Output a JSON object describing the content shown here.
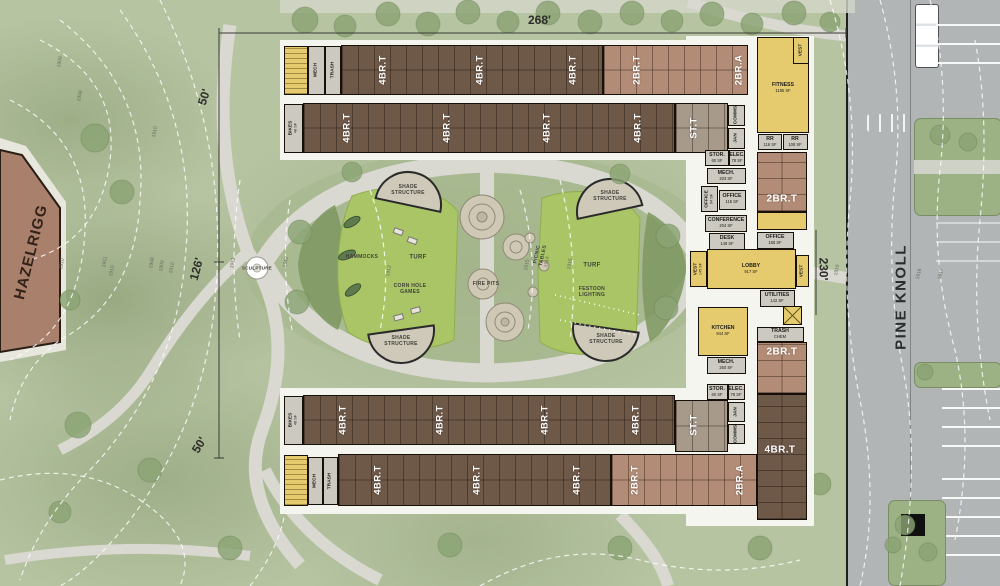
{
  "site": {
    "adjacent_building": "HAZELRIGG",
    "street": "PINE KNOLL"
  },
  "dimensions": {
    "top": "268'",
    "left_upper": "50'",
    "left_mid": "126'",
    "left_lower": "50'",
    "right": "230'"
  },
  "palette": {
    "dark_unit": "#6e5848",
    "light_unit": "#b28c76",
    "amenity_yellow": "#e5cb6e",
    "service_gray": "#ccc9c1",
    "studio_gray": "#a79a8b",
    "turf_green": "#a9c566",
    "grass": "#b7c4a2",
    "path": "#d9d8d1",
    "road": "#b1b5b6"
  },
  "render": {
    "blocks": [
      {
        "n": "pad-north",
        "cls": "pad",
        "x": 280,
        "y": 40,
        "w": 470,
        "h": 120
      },
      {
        "n": "pad-south",
        "cls": "pad",
        "x": 280,
        "y": 388,
        "w": 482,
        "h": 126
      },
      {
        "n": "pad-east",
        "cls": "pad",
        "x": 686,
        "y": 36,
        "w": 128,
        "h": 490
      },
      {
        "n": "stair-room",
        "cls": "f-yel st",
        "x": 284,
        "y": 46,
        "w": 24,
        "h": 49
      },
      {
        "n": "mech-room",
        "cls": "f-gray",
        "x": 308,
        "y": 46,
        "w": 17,
        "h": 49
      },
      {
        "n": "trash-room",
        "cls": "f-gray",
        "x": 325,
        "y": 46,
        "w": 16,
        "h": 49
      },
      {
        "n": "residential-wing",
        "cls": "f-dark u-v",
        "x": 341,
        "y": 45,
        "w": 262,
        "h": 50
      },
      {
        "n": "residential-wing",
        "cls": "f-light u-v",
        "x": 603,
        "y": 45,
        "w": 145,
        "h": 50
      },
      {
        "n": "bike-room",
        "cls": "f-gray",
        "x": 284,
        "y": 104,
        "w": 19,
        "h": 49
      },
      {
        "n": "residential-wing",
        "cls": "f-dark u-v",
        "x": 303,
        "y": 103,
        "w": 372,
        "h": 50
      },
      {
        "n": "studio-wing",
        "cls": "f-stud u-v",
        "x": 675,
        "y": 103,
        "w": 53,
        "h": 50
      },
      {
        "n": "comms-room",
        "cls": "f-gray",
        "x": 728,
        "y": 105,
        "w": 17,
        "h": 21
      },
      {
        "n": "jan-room",
        "cls": "f-gray",
        "x": 728,
        "y": 128,
        "w": 17,
        "h": 21
      },
      {
        "n": "fitness-room",
        "cls": "f-yel",
        "x": 757,
        "y": 37,
        "w": 52,
        "h": 96
      },
      {
        "n": "vest-room",
        "cls": "f-yel",
        "x": 793,
        "y": 37,
        "w": 16,
        "h": 27
      },
      {
        "n": "restroom",
        "cls": "f-gray",
        "x": 758,
        "y": 134,
        "w": 24,
        "h": 16
      },
      {
        "n": "restroom",
        "cls": "f-gray",
        "x": 783,
        "y": 134,
        "w": 25,
        "h": 16
      },
      {
        "n": "stor-room",
        "cls": "f-gray",
        "x": 705,
        "y": 150,
        "w": 24,
        "h": 16
      },
      {
        "n": "elec-room",
        "cls": "f-gray",
        "x": 729,
        "y": 150,
        "w": 16,
        "h": 16
      },
      {
        "n": "mech-room",
        "cls": "f-gray",
        "x": 707,
        "y": 168,
        "w": 39,
        "h": 16
      },
      {
        "n": "office-room",
        "cls": "f-gray",
        "x": 701,
        "y": 186,
        "w": 17,
        "h": 26
      },
      {
        "n": "office-room",
        "cls": "f-gray",
        "x": 719,
        "y": 190,
        "w": 27,
        "h": 20
      },
      {
        "n": "apartment-2brt",
        "cls": "f-light u-h",
        "x": 757,
        "y": 152,
        "w": 50,
        "h": 60
      },
      {
        "n": "balcony-room",
        "cls": "f-yel",
        "x": 757,
        "y": 212,
        "w": 50,
        "h": 18
      },
      {
        "n": "conference-room",
        "cls": "f-gray",
        "x": 705,
        "y": 215,
        "w": 42,
        "h": 17
      },
      {
        "n": "desk-room",
        "cls": "f-gray",
        "x": 709,
        "y": 233,
        "w": 36,
        "h": 17
      },
      {
        "n": "office-room",
        "cls": "f-gray",
        "x": 757,
        "y": 232,
        "w": 37,
        "h": 17
      },
      {
        "n": "vest-room",
        "cls": "f-yel",
        "x": 690,
        "y": 251,
        "w": 17,
        "h": 36
      },
      {
        "n": "lobby-room",
        "cls": "f-yel",
        "x": 707,
        "y": 249,
        "w": 89,
        "h": 40
      },
      {
        "n": "vest-room",
        "cls": "f-yel",
        "x": 796,
        "y": 255,
        "w": 13,
        "h": 32
      },
      {
        "n": "utilities-room",
        "cls": "f-gray",
        "x": 760,
        "y": 290,
        "w": 35,
        "h": 17
      },
      {
        "n": "kitchen-room",
        "cls": "f-yel",
        "x": 698,
        "y": 307,
        "w": 50,
        "h": 49
      },
      {
        "n": "stair-x-room",
        "cls": "f-yel xr",
        "x": 783,
        "y": 306,
        "w": 19,
        "h": 19
      },
      {
        "n": "trash-room",
        "cls": "f-gray",
        "x": 757,
        "y": 327,
        "w": 47,
        "h": 15
      },
      {
        "n": "apartment-2brt",
        "cls": "f-light u-h",
        "x": 757,
        "y": 342,
        "w": 50,
        "h": 52
      },
      {
        "n": "mech-room",
        "cls": "f-gray",
        "x": 707,
        "y": 357,
        "w": 39,
        "h": 17
      },
      {
        "n": "stor-room",
        "cls": "f-gray",
        "x": 707,
        "y": 384,
        "w": 21,
        "h": 16
      },
      {
        "n": "elec-room",
        "cls": "f-gray",
        "x": 728,
        "y": 384,
        "w": 17,
        "h": 16
      },
      {
        "n": "bike-room",
        "cls": "f-gray",
        "x": 284,
        "y": 396,
        "w": 19,
        "h": 49
      },
      {
        "n": "residential-wing",
        "cls": "f-dark u-v",
        "x": 303,
        "y": 395,
        "w": 372,
        "h": 50
      },
      {
        "n": "studio-wing",
        "cls": "f-stud u-v",
        "x": 675,
        "y": 400,
        "w": 53,
        "h": 52
      },
      {
        "n": "jan-room",
        "cls": "f-gray",
        "x": 728,
        "y": 402,
        "w": 17,
        "h": 20
      },
      {
        "n": "comms-room",
        "cls": "f-gray",
        "x": 728,
        "y": 424,
        "w": 17,
        "h": 20
      },
      {
        "n": "stair-room",
        "cls": "f-yel st",
        "x": 284,
        "y": 455,
        "w": 24,
        "h": 51
      },
      {
        "n": "mech-room",
        "cls": "f-gray",
        "x": 308,
        "y": 457,
        "w": 15,
        "h": 48
      },
      {
        "n": "trash-room",
        "cls": "f-gray",
        "x": 323,
        "y": 457,
        "w": 15,
        "h": 48
      },
      {
        "n": "residential-wing",
        "cls": "f-dark u-v",
        "x": 338,
        "y": 454,
        "w": 273,
        "h": 52
      },
      {
        "n": "residential-wing",
        "cls": "f-light u-v",
        "x": 611,
        "y": 454,
        "w": 146,
        "h": 52
      },
      {
        "n": "residential-wing",
        "cls": "f-dark u-h",
        "x": 757,
        "y": 394,
        "w": 50,
        "h": 126
      }
    ],
    "unit_labels": [
      {
        "t": "4BR.T",
        "x": 383,
        "y": 70
      },
      {
        "t": "4BR.T",
        "x": 480,
        "y": 70
      },
      {
        "t": "4BR.T",
        "x": 573,
        "y": 70
      },
      {
        "t": "2BR.T",
        "x": 637,
        "y": 70
      },
      {
        "t": "2BR.A",
        "x": 739,
        "y": 70
      },
      {
        "t": "4BR.T",
        "x": 347,
        "y": 128
      },
      {
        "t": "4BR.T",
        "x": 447,
        "y": 128
      },
      {
        "t": "4BR.T",
        "x": 547,
        "y": 128
      },
      {
        "t": "4BR.T",
        "x": 638,
        "y": 128
      },
      {
        "t": "ST.T",
        "x": 694,
        "y": 128
      },
      {
        "t": "4BR.T",
        "x": 343,
        "y": 420
      },
      {
        "t": "4BR.T",
        "x": 440,
        "y": 420
      },
      {
        "t": "4BR.T",
        "x": 545,
        "y": 420
      },
      {
        "t": "4BR.T",
        "x": 636,
        "y": 420
      },
      {
        "t": "ST.T",
        "x": 694,
        "y": 425
      },
      {
        "t": "4BR.T",
        "x": 378,
        "y": 480
      },
      {
        "t": "4BR.T",
        "x": 477,
        "y": 480
      },
      {
        "t": "4BR.T",
        "x": 577,
        "y": 480
      },
      {
        "t": "2BR.T",
        "x": 635,
        "y": 480
      },
      {
        "t": "2BR.A",
        "x": 740,
        "y": 480
      },
      {
        "t": "2BR.T",
        "x": 782,
        "y": 199,
        "h": true,
        "s": 10
      },
      {
        "t": "2BR.T",
        "x": 782,
        "y": 352,
        "h": true,
        "s": 10
      },
      {
        "t": "4BR.T",
        "x": 780,
        "y": 450,
        "h": true,
        "s": 10
      }
    ],
    "service_labels": [
      {
        "t": "MECH",
        "x": 316,
        "y": 70
      },
      {
        "t": "TRASH",
        "x": 333,
        "y": 70
      },
      {
        "t": "BIKES",
        "sf": "48 SF",
        "x": 293,
        "y": 128
      },
      {
        "t": "COMMS",
        "x": 736,
        "y": 115
      },
      {
        "t": "JAN",
        "x": 736,
        "y": 138
      },
      {
        "t": "VEST",
        "x": 801,
        "y": 50
      },
      {
        "t": "OFFICE",
        "sf": "94 SF",
        "x": 709,
        "y": 199
      },
      {
        "t": "VEST",
        "sf": "145 SF",
        "x": 698,
        "y": 269
      },
      {
        "t": "VEST",
        "x": 802,
        "y": 271
      },
      {
        "t": "BIKES",
        "sf": "48 SF",
        "x": 293,
        "y": 420
      },
      {
        "t": "JAN",
        "x": 736,
        "y": 412
      },
      {
        "t": "COMMS",
        "x": 736,
        "y": 434
      },
      {
        "t": "MECH",
        "x": 315,
        "y": 481
      },
      {
        "t": "TRASH",
        "x": 330,
        "y": 481
      }
    ],
    "room_labels": [
      {
        "t": "FITNESS",
        "sf": "1195 SF",
        "x": 783,
        "y": 88
      },
      {
        "t": "RR",
        "sf": "116 SF",
        "x": 770,
        "y": 142
      },
      {
        "t": "RR",
        "sf": "108 SF",
        "x": 795,
        "y": 142
      },
      {
        "t": "STOR.",
        "sf": "60 SF",
        "x": 717,
        "y": 158
      },
      {
        "t": "ELEC.",
        "sf": "78 SF",
        "x": 737,
        "y": 158
      },
      {
        "t": "MECH.",
        "sf": "203 SF",
        "x": 726,
        "y": 176
      },
      {
        "t": "OFFICE",
        "sf": "115 SF",
        "x": 732,
        "y": 199
      },
      {
        "t": "CONFERENCE",
        "sf": "204 SF",
        "x": 726,
        "y": 223
      },
      {
        "t": "DESK",
        "sf": "148 SF",
        "x": 727,
        "y": 241
      },
      {
        "t": "OFFICE",
        "sf": "158 SF",
        "x": 775,
        "y": 240
      },
      {
        "t": "LOBBY",
        "sf": "917 SF",
        "x": 751,
        "y": 269
      },
      {
        "t": "UTILITIES",
        "sf": "142 SF",
        "x": 777,
        "y": 298
      },
      {
        "t": "KITCHEN",
        "sf": "944 SF",
        "x": 723,
        "y": 331
      },
      {
        "t": "TRASH",
        "sf": "CHEM",
        "x": 780,
        "y": 334
      },
      {
        "t": "MECH.",
        "sf": "260 SF",
        "x": 726,
        "y": 365
      },
      {
        "t": "STOR.",
        "sf": "60 SF",
        "x": 717,
        "y": 392
      },
      {
        "t": "ELEC.",
        "sf": "78 SF",
        "x": 736,
        "y": 392
      }
    ],
    "park_labels": [
      {
        "t": "SHADE\nSTRUCTURE",
        "x": 408,
        "y": 190
      },
      {
        "t": "SHADE\nSTRUCTURE",
        "x": 610,
        "y": 196
      },
      {
        "t": "SHADE\nSTRUCTURE",
        "x": 401,
        "y": 341
      },
      {
        "t": "SHADE\nSTRUCTURE",
        "x": 606,
        "y": 339
      },
      {
        "t": "HAMMOCKS",
        "x": 362,
        "y": 257
      },
      {
        "t": "TURF",
        "x": 418,
        "y": 258,
        "s": 6
      },
      {
        "t": "TURF",
        "x": 592,
        "y": 266,
        "s": 6
      },
      {
        "t": "CORN HOLE\nGAMES",
        "x": 410,
        "y": 289
      },
      {
        "t": "FIRE PITS",
        "x": 486,
        "y": 284
      },
      {
        "t": "PICNIC\nTABLES",
        "x": 540,
        "y": 255,
        "r": -78
      },
      {
        "t": "FESTOON\nLIGHTING",
        "x": 592,
        "y": 292
      },
      {
        "t": "SCULPTURE",
        "x": 257,
        "y": 268,
        "s": 4.5
      }
    ],
    "contour_labels": [
      {
        "t": "1909",
        "x": 60,
        "y": 62
      },
      {
        "t": "1908",
        "x": 80,
        "y": 96
      },
      {
        "t": "1910",
        "x": 155,
        "y": 132
      },
      {
        "t": "1910",
        "x": 62,
        "y": 264
      },
      {
        "t": "1911",
        "x": 105,
        "y": 262
      },
      {
        "t": "1910",
        "x": 112,
        "y": 271
      },
      {
        "t": "1908",
        "x": 152,
        "y": 263
      },
      {
        "t": "1909",
        "x": 162,
        "y": 266
      },
      {
        "t": "1910",
        "x": 172,
        "y": 268
      },
      {
        "t": "1911",
        "x": 233,
        "y": 263
      },
      {
        "t": "1912",
        "x": 286,
        "y": 262
      },
      {
        "t": "1913",
        "x": 389,
        "y": 271
      },
      {
        "t": "1915",
        "x": 527,
        "y": 265
      },
      {
        "t": "1914",
        "x": 547,
        "y": 262
      },
      {
        "t": "1916",
        "x": 570,
        "y": 264
      },
      {
        "t": "1916",
        "x": 837,
        "y": 270
      },
      {
        "t": "1916",
        "x": 919,
        "y": 274,
        "r": -75
      },
      {
        "t": "1917",
        "x": 941,
        "y": 274,
        "r": -75
      }
    ]
  }
}
